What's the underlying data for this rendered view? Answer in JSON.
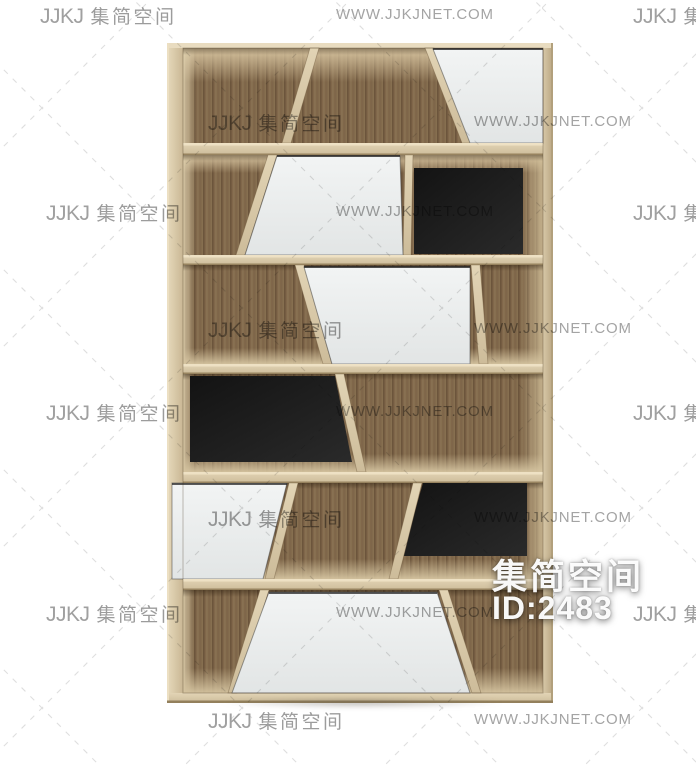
{
  "page": {
    "background_color": "#ffffff"
  },
  "watermarks": {
    "logo_text": "JJKJ",
    "brand_text": "集简空间",
    "url_text": "WWW.JJKJNET.COM",
    "text_color": "#9c9c9c",
    "dash_line_color": "#c8c8c8"
  },
  "id_badge": {
    "brand_text": "集简空间",
    "id_text": "ID:2483",
    "text_color": "#ffffff"
  },
  "product_render": {
    "name": "wooden display bookshelf with slanted dividers",
    "wood_frame_color": "#d6c6a6",
    "wood_interior_color": "#80674a",
    "door_color": "#eef0f0",
    "panel_color": "#1a1a1a"
  }
}
